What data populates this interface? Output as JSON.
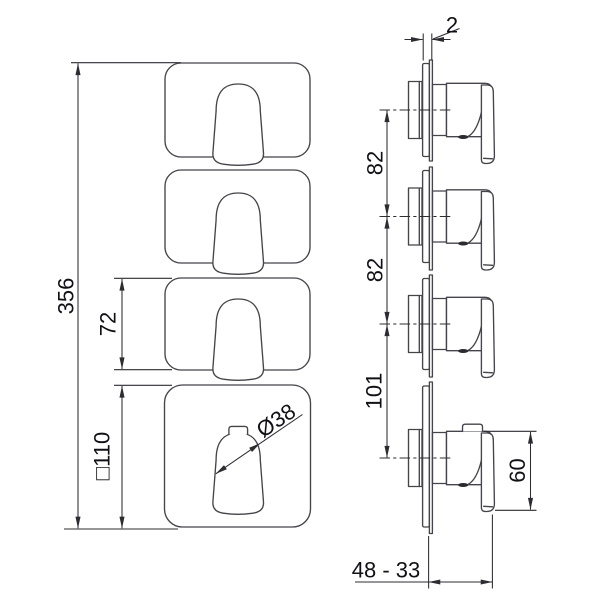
{
  "front_view": {
    "total_height_label": "356",
    "plate_height_label": "72",
    "plate_size_label": "□110",
    "handle_diameter_label": "Ø38"
  },
  "side_view": {
    "plate_thickness_label": "2",
    "spacing_top_label": "82",
    "spacing_middle_label": "82",
    "spacing_bottom_label": "101",
    "handle_height_label": "60",
    "depth_range_label": "48 - 33"
  },
  "colors": {
    "background": "#ffffff",
    "outline": "#44444b",
    "dimension_line": "#2c2c33",
    "text": "#101016"
  }
}
